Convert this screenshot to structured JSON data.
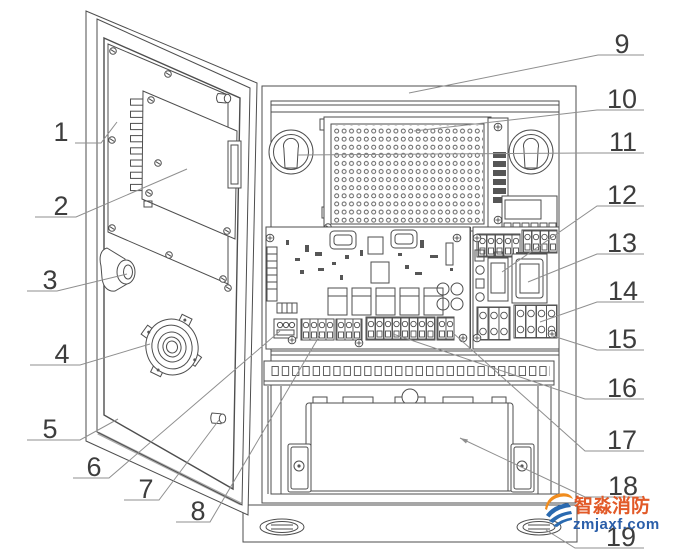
{
  "figure": {
    "kind": "technical-line-drawing",
    "subject": "control panel cabinet with open door, numbered part callouts"
  },
  "callouts": [
    {
      "label": "1"
    },
    {
      "label": "2"
    },
    {
      "label": "3"
    },
    {
      "label": "4"
    },
    {
      "label": "5"
    },
    {
      "label": "6"
    },
    {
      "label": "7"
    },
    {
      "label": "8"
    },
    {
      "label": "9"
    },
    {
      "label": "10"
    },
    {
      "label": "11"
    },
    {
      "label": "12"
    },
    {
      "label": "13"
    },
    {
      "label": "14"
    },
    {
      "label": "15"
    },
    {
      "label": "16"
    },
    {
      "label": "17"
    },
    {
      "label": "18"
    },
    {
      "label": "19"
    }
  ],
  "watermark": {
    "brand_text": "智淼消防",
    "site_text": "zmjaxf.com",
    "brand_color": "#e25a28",
    "site_color": "#2a5ea9",
    "logo_orange": "#f08c1e",
    "logo_blue": "#2a6ab0"
  }
}
